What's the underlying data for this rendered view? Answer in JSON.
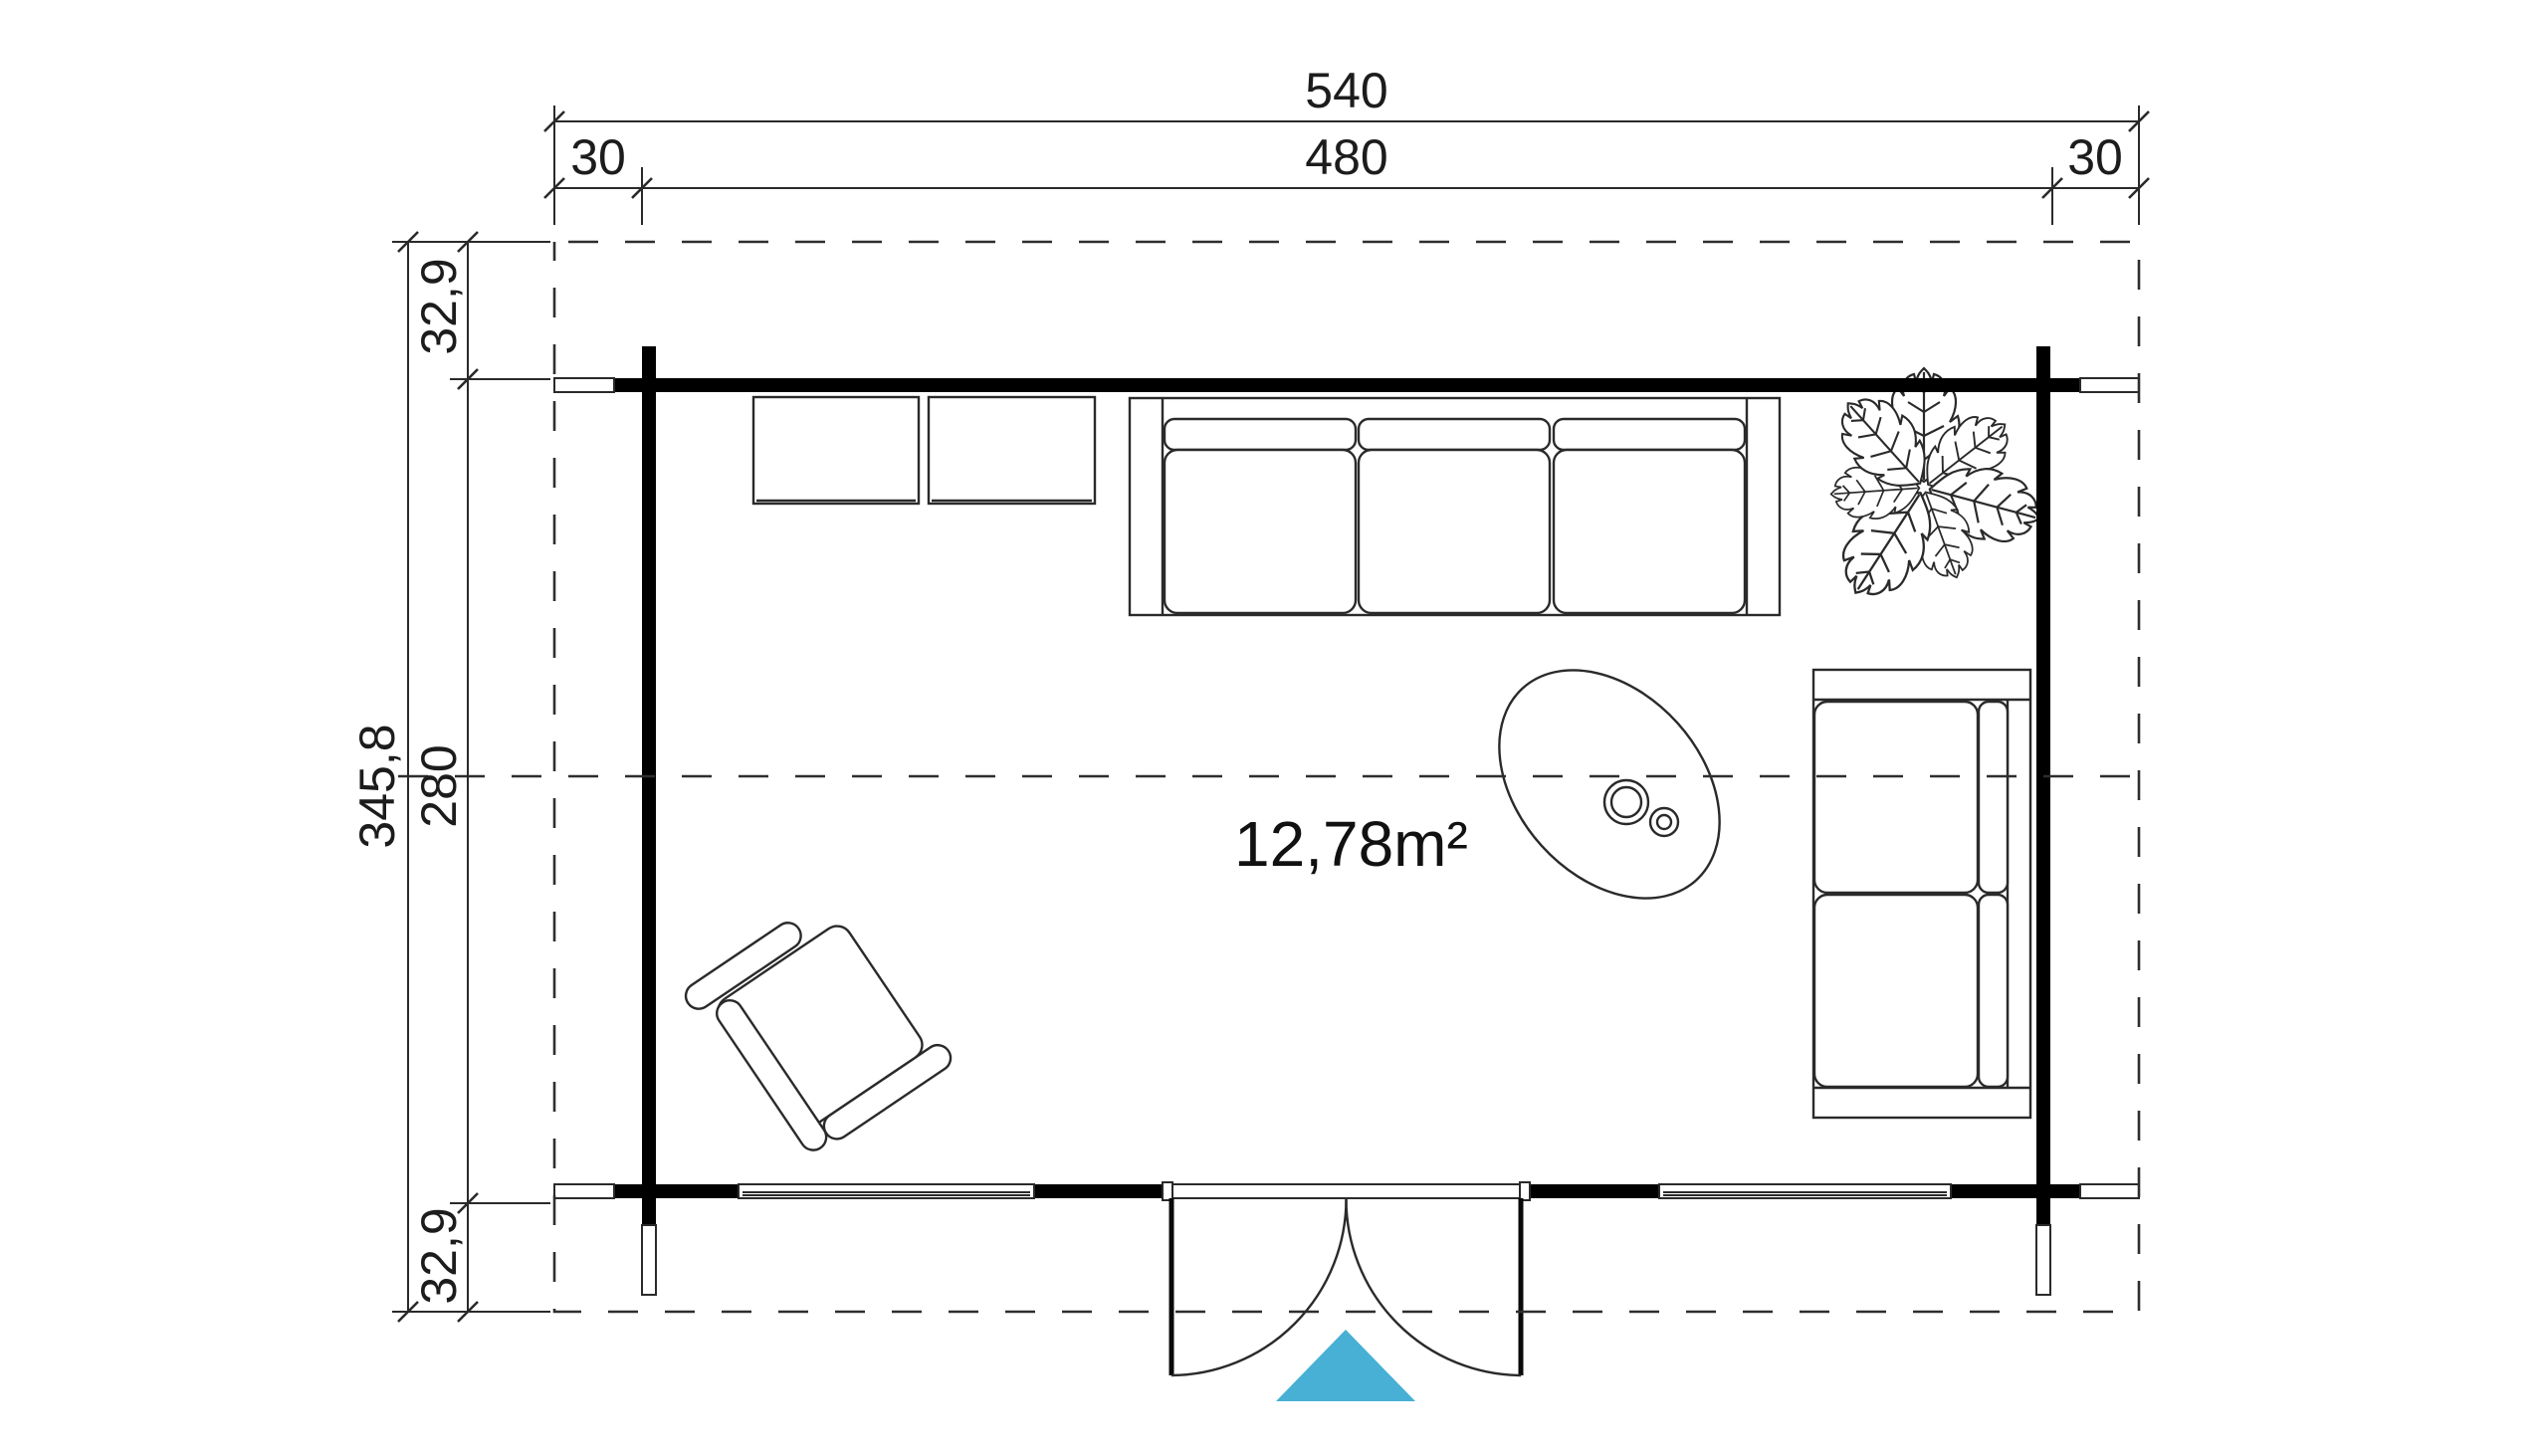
{
  "title": "log-cabin-floor-plan",
  "area": {
    "label": "12,78m²"
  },
  "dimensions": {
    "horizontal": {
      "total": "540",
      "left_overhang": "30",
      "body": "480",
      "right_overhang": "30"
    },
    "vertical": {
      "total": "345,8",
      "top_overhang": "32,9",
      "body": "280",
      "bottom_overhang": "32,9"
    }
  },
  "colors": {
    "wall": "#000000",
    "line": "#2a2a2a",
    "entrance_arrow": "#47b0d4",
    "background": "#ffffff"
  },
  "elements": {
    "door": "double-swing-entrance-door",
    "furniture": [
      "sideboard-left",
      "sideboard-right",
      "three-seat-sofa",
      "potted-plant",
      "oval-coffee-table",
      "two-seat-sofa",
      "armchair"
    ]
  }
}
